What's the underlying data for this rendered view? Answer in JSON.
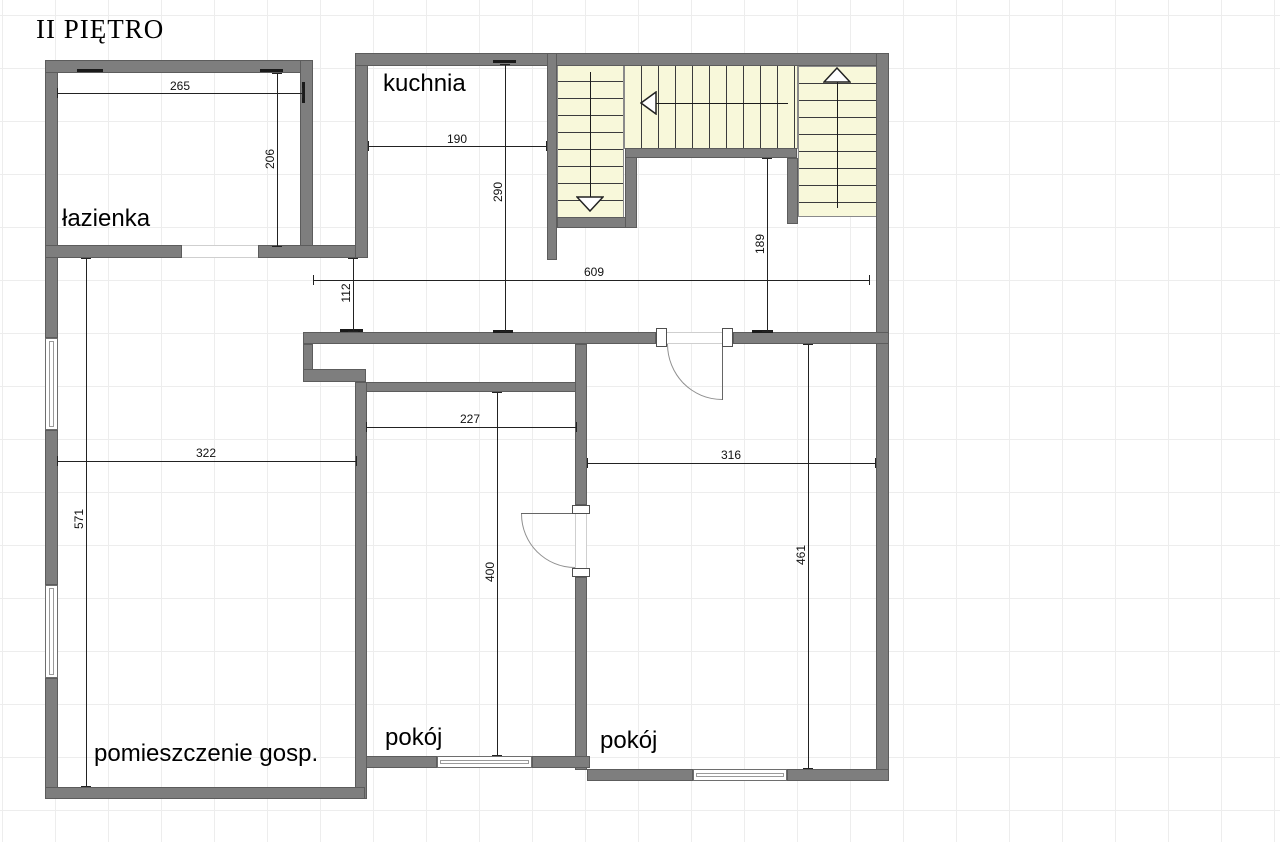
{
  "title": "II PIĘTRO",
  "rooms": {
    "kitchen": "kuchnia",
    "bathroom": "łazienka",
    "utility": "pomieszczenie gosp.",
    "room1": "pokój",
    "room2": "pokój"
  },
  "dimensions": {
    "bathroom_width": "265",
    "bathroom_depth": "206",
    "kitchen_width": "190",
    "kitchen_depth": "290",
    "hall_width": "609",
    "hall_nook_depth": "112",
    "stairwell_depth": "189",
    "room1_width": "227",
    "utility_width": "322",
    "room2_width": "316",
    "utility_depth": "571",
    "room1_depth": "400",
    "room2_depth": "461"
  },
  "colors": {
    "wall_fill": "#7e7e7e",
    "wall_outline": "#5c5c5c",
    "stairs_fill": "#f8f8da",
    "dimension_line": "#222222",
    "grid_line": "#ededed"
  }
}
